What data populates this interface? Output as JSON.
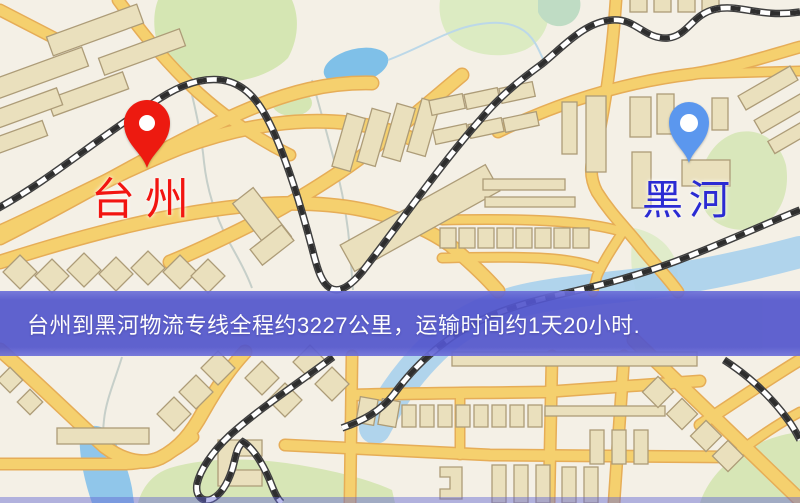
{
  "map": {
    "markers": [
      {
        "id": "origin",
        "label": "台州",
        "icon": "location-pin-icon",
        "pin_color": "#ed1a10",
        "label_color": "#f21511"
      },
      {
        "id": "destination",
        "label": "黑河",
        "icon": "location-pin-icon",
        "pin_color": "#5b97ee",
        "label_color": "#2b2bd3"
      }
    ],
    "banner": {
      "text": "台州到黑河物流专线全程约3227公里，运输时间约1天20小时.",
      "background": "#5356cd",
      "text_color": "#ffffff"
    },
    "route": {
      "origin_city": "台州",
      "destination_city": "黑河",
      "distance_text": "约3227公里",
      "duration_text": "约1天20小时"
    }
  }
}
